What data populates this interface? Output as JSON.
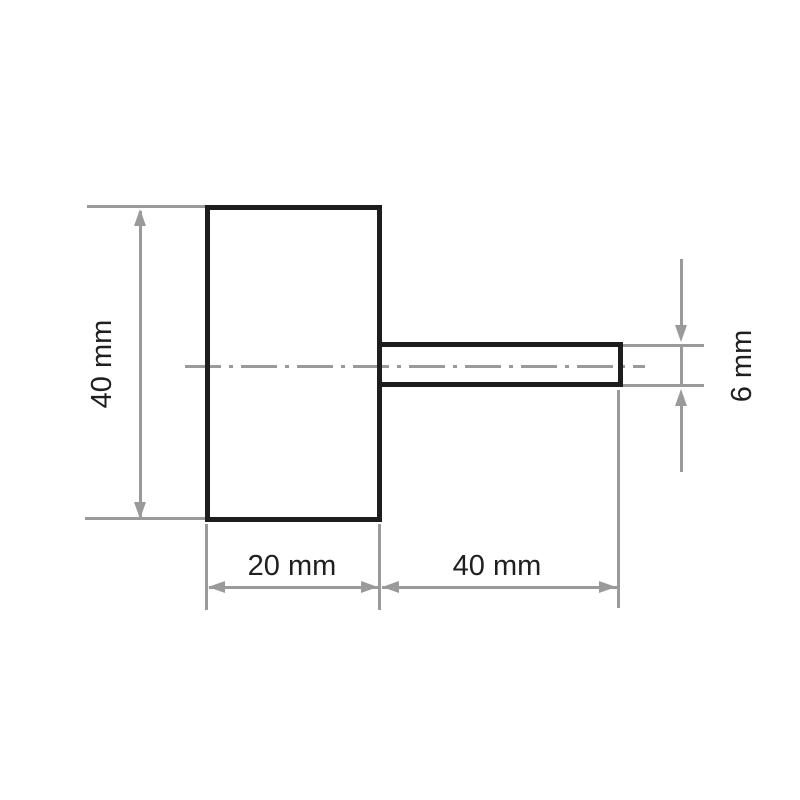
{
  "drawing": {
    "type": "technical-dimension-drawing",
    "part": "wheel-body-with-shaft"
  },
  "labels": {
    "body_height": "40 mm",
    "body_width": "20 mm",
    "shaft_length": "40 mm",
    "shaft_diameter": "6 mm"
  },
  "dimensions_mm": {
    "body_height": 40,
    "body_width": 20,
    "shaft_length": 40,
    "shaft_diameter": 6
  },
  "colors": {
    "outline": "#1d1d1d",
    "dimension_lines": "#9a9a9a",
    "text": "#1f1f1f",
    "background": "#ffffff"
  }
}
